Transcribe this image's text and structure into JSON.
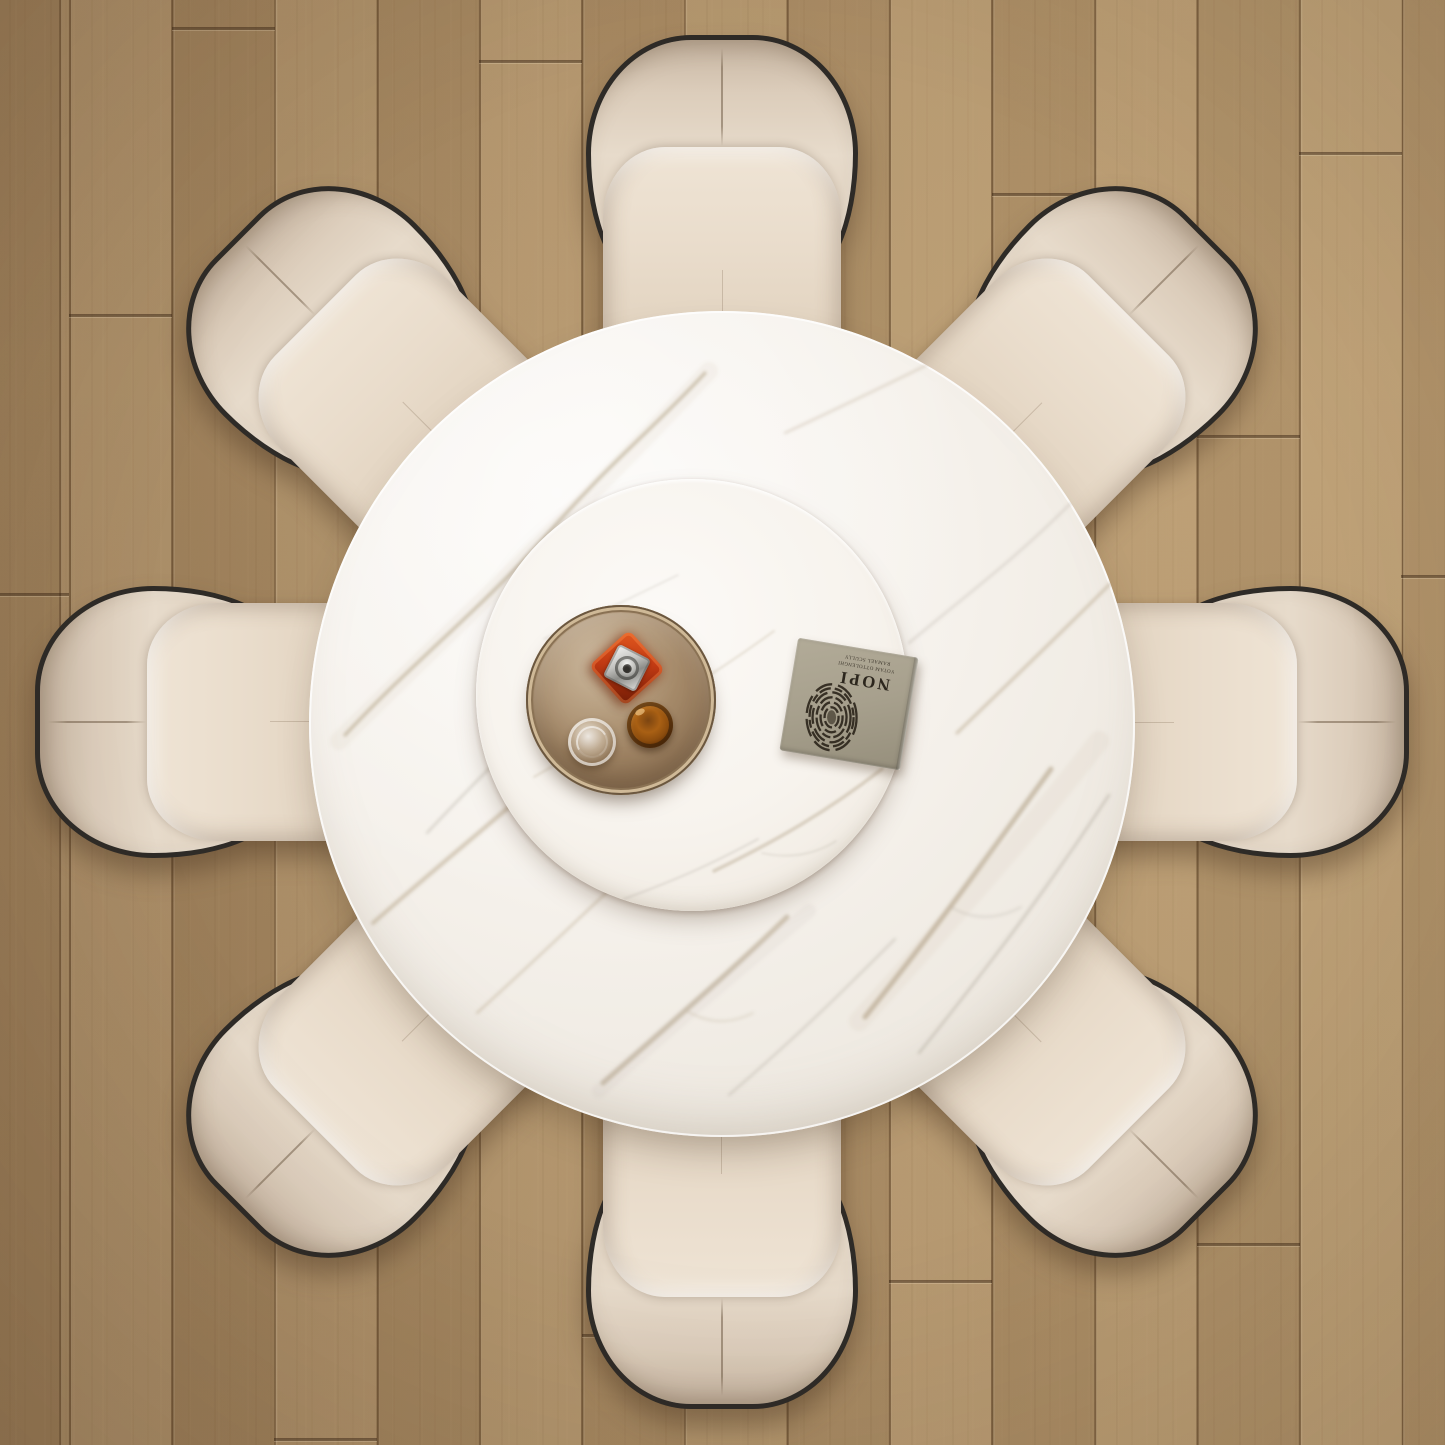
{
  "scene": {
    "description": "Overhead (bird's-eye) render of a modern dining set: a round white marble dining table with a built-in rotating lazy susan, surrounded by eight beige leather dining chairs with dark trim, on oak plank flooring.",
    "view": "top-down",
    "chair_count": 8
  },
  "book": {
    "title": "NOPI",
    "author_line_1": "YOTAM OTTOLENGHI",
    "author_line_2": "RAMAEL SCULLY",
    "orientation": "upside down on tabletop",
    "cover_art": "large dark fingerprint"
  },
  "tabletop_items": {
    "tray": "round bronze mirror serving tray",
    "decanter": "square red glass decanter with chrome stopper",
    "whiskey_glass": "amber glass tumbler",
    "water_glass": "clear glass tumbler"
  },
  "chairs": {
    "positions": [
      "top",
      "top-right",
      "right",
      "bottom-right",
      "bottom",
      "bottom-left",
      "left",
      "top-left"
    ],
    "style": "beige leather wrap-around backrest with dark piping and center stitch"
  },
  "colors": {
    "floor_oak": "#b2946b",
    "plank_gap": "#523a1e",
    "marble_base": "#f5f1eb",
    "marble_vein_tan": "#b9a88e",
    "marble_vein_gray": "#a79f93",
    "lazy_susan": "#f7f3ed",
    "chair_leather": "#e2d5c4",
    "chair_trim": "#2e2b27",
    "tray_bronze": "#ab906f",
    "decanter_red": "#c13a13",
    "whiskey_amber": "#8d4d0e",
    "book_cover": "#a7a08d"
  }
}
